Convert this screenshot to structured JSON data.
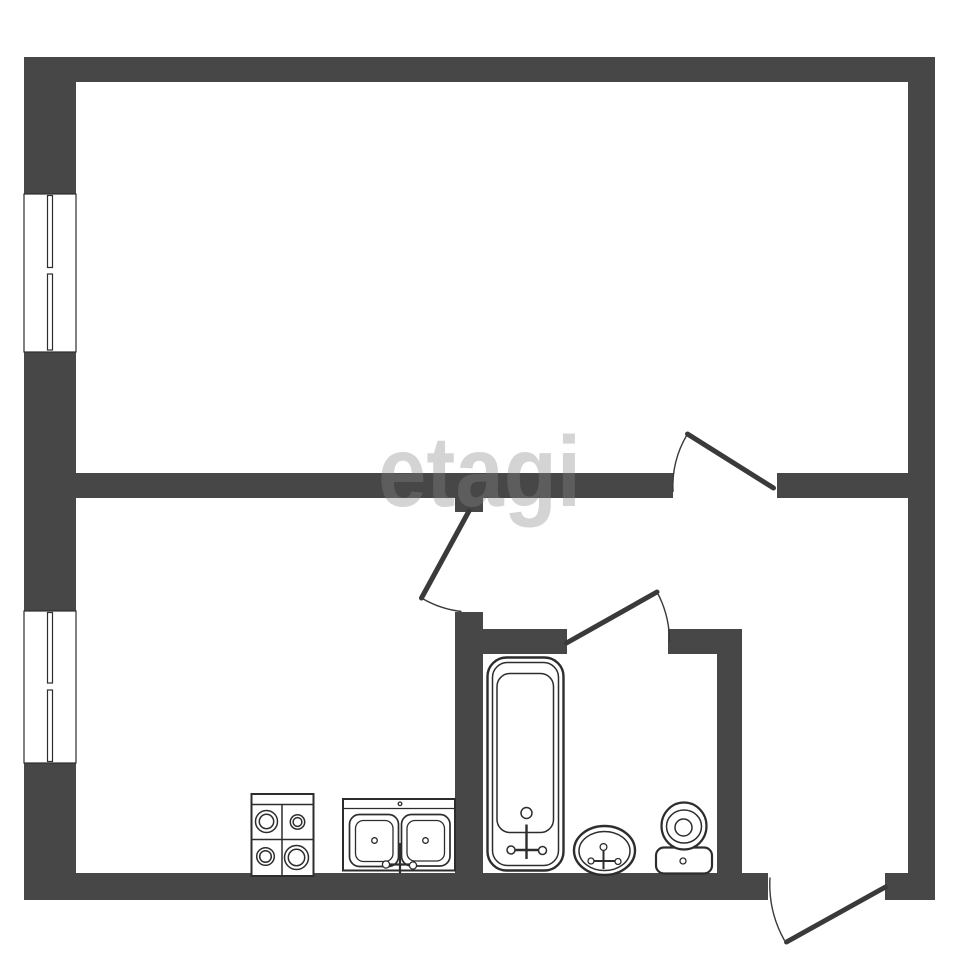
{
  "watermark": {
    "text": "etagi"
  },
  "colors": {
    "paper": "#ffffff",
    "wall": "#474747",
    "line": "#2d2d2d",
    "door": "#3a3a3a",
    "watermark": "#868686"
  },
  "plan": {
    "type": "apartment-floor-plan",
    "windows_count": 2,
    "doors_count": 4,
    "icons": [
      "window-icon",
      "door-swing-icon",
      "stove-icon",
      "kitchen-sink-icon",
      "bathtub-icon",
      "washbasin-icon",
      "toilet-icon"
    ]
  }
}
